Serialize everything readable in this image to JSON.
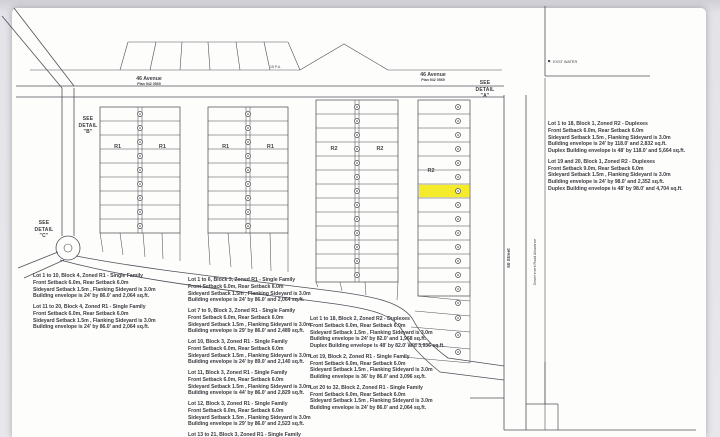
{
  "colors": {
    "ink": "#46464c",
    "ink_light": "#6a6a71",
    "highlight": "#f4eb2b",
    "paper": "#fdfdfc"
  },
  "title_labels": {
    "see_detail_a": [
      "SEE",
      "DETAIL",
      "\"A\""
    ],
    "see_detail_b": [
      "SEE",
      "DETAIL",
      "\"B\""
    ],
    "see_detail_c": [
      "SEE",
      "DETAIL",
      "\"C\""
    ]
  },
  "streets": {
    "avenue_west": {
      "name": "46 Avenue",
      "plan": "Plan 942 0569"
    },
    "avenue_east": {
      "name": "46 Avenue",
      "plan": "Plan 942 0569"
    },
    "street_right": "50 Street",
    "road_allowance": "Government Road Allowance",
    "water_note": "EXST WATER",
    "pu_note": "15 P.U."
  },
  "map": {
    "blocks": [
      {
        "id": "block4",
        "x": 100,
        "y": 107,
        "w": 80,
        "rows": 9,
        "rowH": 14,
        "cols": 2,
        "zone": "R1",
        "zoneY": 148
      },
      {
        "id": "block3",
        "x": 208,
        "y": 107,
        "w": 80,
        "rows": 9,
        "rowH": 14,
        "cols": 2,
        "zone": "R1",
        "zoneY": 148
      },
      {
        "id": "block2",
        "x": 316,
        "y": 100,
        "w": 82,
        "rows": 13,
        "rowH": 14,
        "cols": 2,
        "zone": "R2",
        "zoneY": 150
      },
      {
        "id": "block1",
        "x": 418,
        "y": 100,
        "w": 52,
        "rows": 14,
        "rowH": 14,
        "cols": 1,
        "zone": "R2",
        "zoneY": 172,
        "circleX": 458,
        "highlightRow": 6,
        "extraCircles": [
          [
            458,
            303
          ],
          [
            458,
            318
          ],
          [
            458,
            335
          ],
          [
            458,
            352
          ]
        ]
      }
    ]
  },
  "notes": {
    "block1_top_right": [
      [
        "Lot 1 to 18, Block 1, Zoned R2 - Duplexes",
        "Front Setback 6.0m, Rear Setback 6.0m",
        "Sideyard Setback 1.5m , Flanking Sideyard is 3.0m",
        "Building envelope is 24' by 118.0'  and 2,832 sq.ft.",
        "Duplex Building envelope is 48' by 118.0'  and 5,664 sq.ft."
      ],
      [
        "Lot 19 and 20, Block 1, Zoned R2 - Duplexes",
        "Front Setback 9.0m, Rear Setback 6.0m",
        "Sideyard Setback 1.5m , Flanking Sideyard is 3.0m",
        "Building envelope is 24' by 98.0'  and 2,352 sq.ft.",
        "Duplex Building envelope is 48' by 98.0'  and 4,704 sq.ft."
      ]
    ],
    "block4_bottom_left": [
      [
        "Lot 1 to 10, Block 4, Zoned R1 - Single Family",
        "Front Setback 6.0m, Rear Setback 6.0m",
        "Sideyard Setback 1.5m , Flanking Sideyard is 3.0m",
        "Building envelope is 24' by 86.0'  and 2,064 sq.ft."
      ],
      [
        "Lot 11 to 20, Block 4, Zoned R1 - Single Family",
        "Front Setback 6.0m, Rear Setback 6.0m",
        "Sideyard Setback 1.5m , Flanking Sideyard is 3.0m",
        "Building envelope is 24' by 86.0'  and 2,064 sq.ft."
      ]
    ],
    "block3_bottom_middle": [
      [
        "Lot 1 to 6, Block 3, Zoned R1 - Single Family",
        "Front Setback 6.0m, Rear Setback 6.0m",
        "Sideyard Setback 1.5m , Flanking Sideyard is 3.0m",
        "Building envelope is 24' by 86.0'  and 2,064 sq.ft."
      ],
      [
        "Lot 7 to 9, Block 3, Zoned R1 - Single Family",
        "Front Setback 6.0m, Rear Setback 6.0m",
        "Sideyard Setback 1.5m , Flanking Sideyard is 3.0m",
        "Building envelope is 29' by 86.0'  and 2,489 sq.ft."
      ],
      [
        "Lot 10, Block 3, Zoned R1 - Single Family",
        "Front Setback 6.0m, Rear Setback 6.0m",
        "Sideyard Setback 1.5m , Flanking Sideyard is 3.0m",
        "Building envelope is 24' by 89.0'  and 2,140 sq.ft."
      ],
      [
        "Lot 11, Block 3, Zoned R1 - Single Family",
        "Front Setback 6.0m, Rear Setback 6.0m",
        "Sideyard Setback 1.5m , Flanking Sideyard is 3.0m",
        "Building envelope is 44' by 86.0'  and 2,829 sq.ft."
      ],
      [
        "Lot 12, Block 3, Zoned R1 - Single Family",
        "Front Setback 6.0m, Rear Setback 6.0m",
        "Sideyard Setback 1.5m , Flanking Sideyard is 3.0m",
        "Building envelope is 29' by 86.0'  and 2,523 sq.ft."
      ],
      [
        "Lot 13 to 21, Block 3, Zoned R1 - Single Family",
        "Front Setback 6.0m, Rear Setback 6.0m",
        "Sideyard Setback 1.5m , Flanking Sideyard is 3.0m"
      ]
    ],
    "block2_bottom_right": [
      [
        "Lot 1 to 18, Block 2, Zoned R2 - Duplexes",
        "Front Setback 6.0m, Rear Setback 6.0m",
        "Sideyard Setback 1.5m , Flanking Sideyard is 3.0m",
        "Building envelope is 24' by 82.0'  and 1,968 sq.ft.",
        "Duplex Building envelope is 48' by 82.0'  and 3,936 sq.ft."
      ],
      [
        "Lot 19, Block 2, Zoned R1 - Single Family",
        "Front Setback 6.0m, Rear Setback 6.0m",
        "Sideyard Setback 1.5m , Flanking Sideyard is 3.0m",
        "Building envelope is 36' by 86.0'  and 3,096 sq.ft."
      ],
      [
        "Lot 20 to 32, Block 2, Zoned R1 - Single Family",
        "Front Setback 6.0m, Rear Setback 6.0m",
        "Sideyard Setback 1.5m , Flanking Sideyard is 3.0m",
        "Building envelope is 24' by 86.0'  and 2,064 sq.ft."
      ]
    ]
  }
}
